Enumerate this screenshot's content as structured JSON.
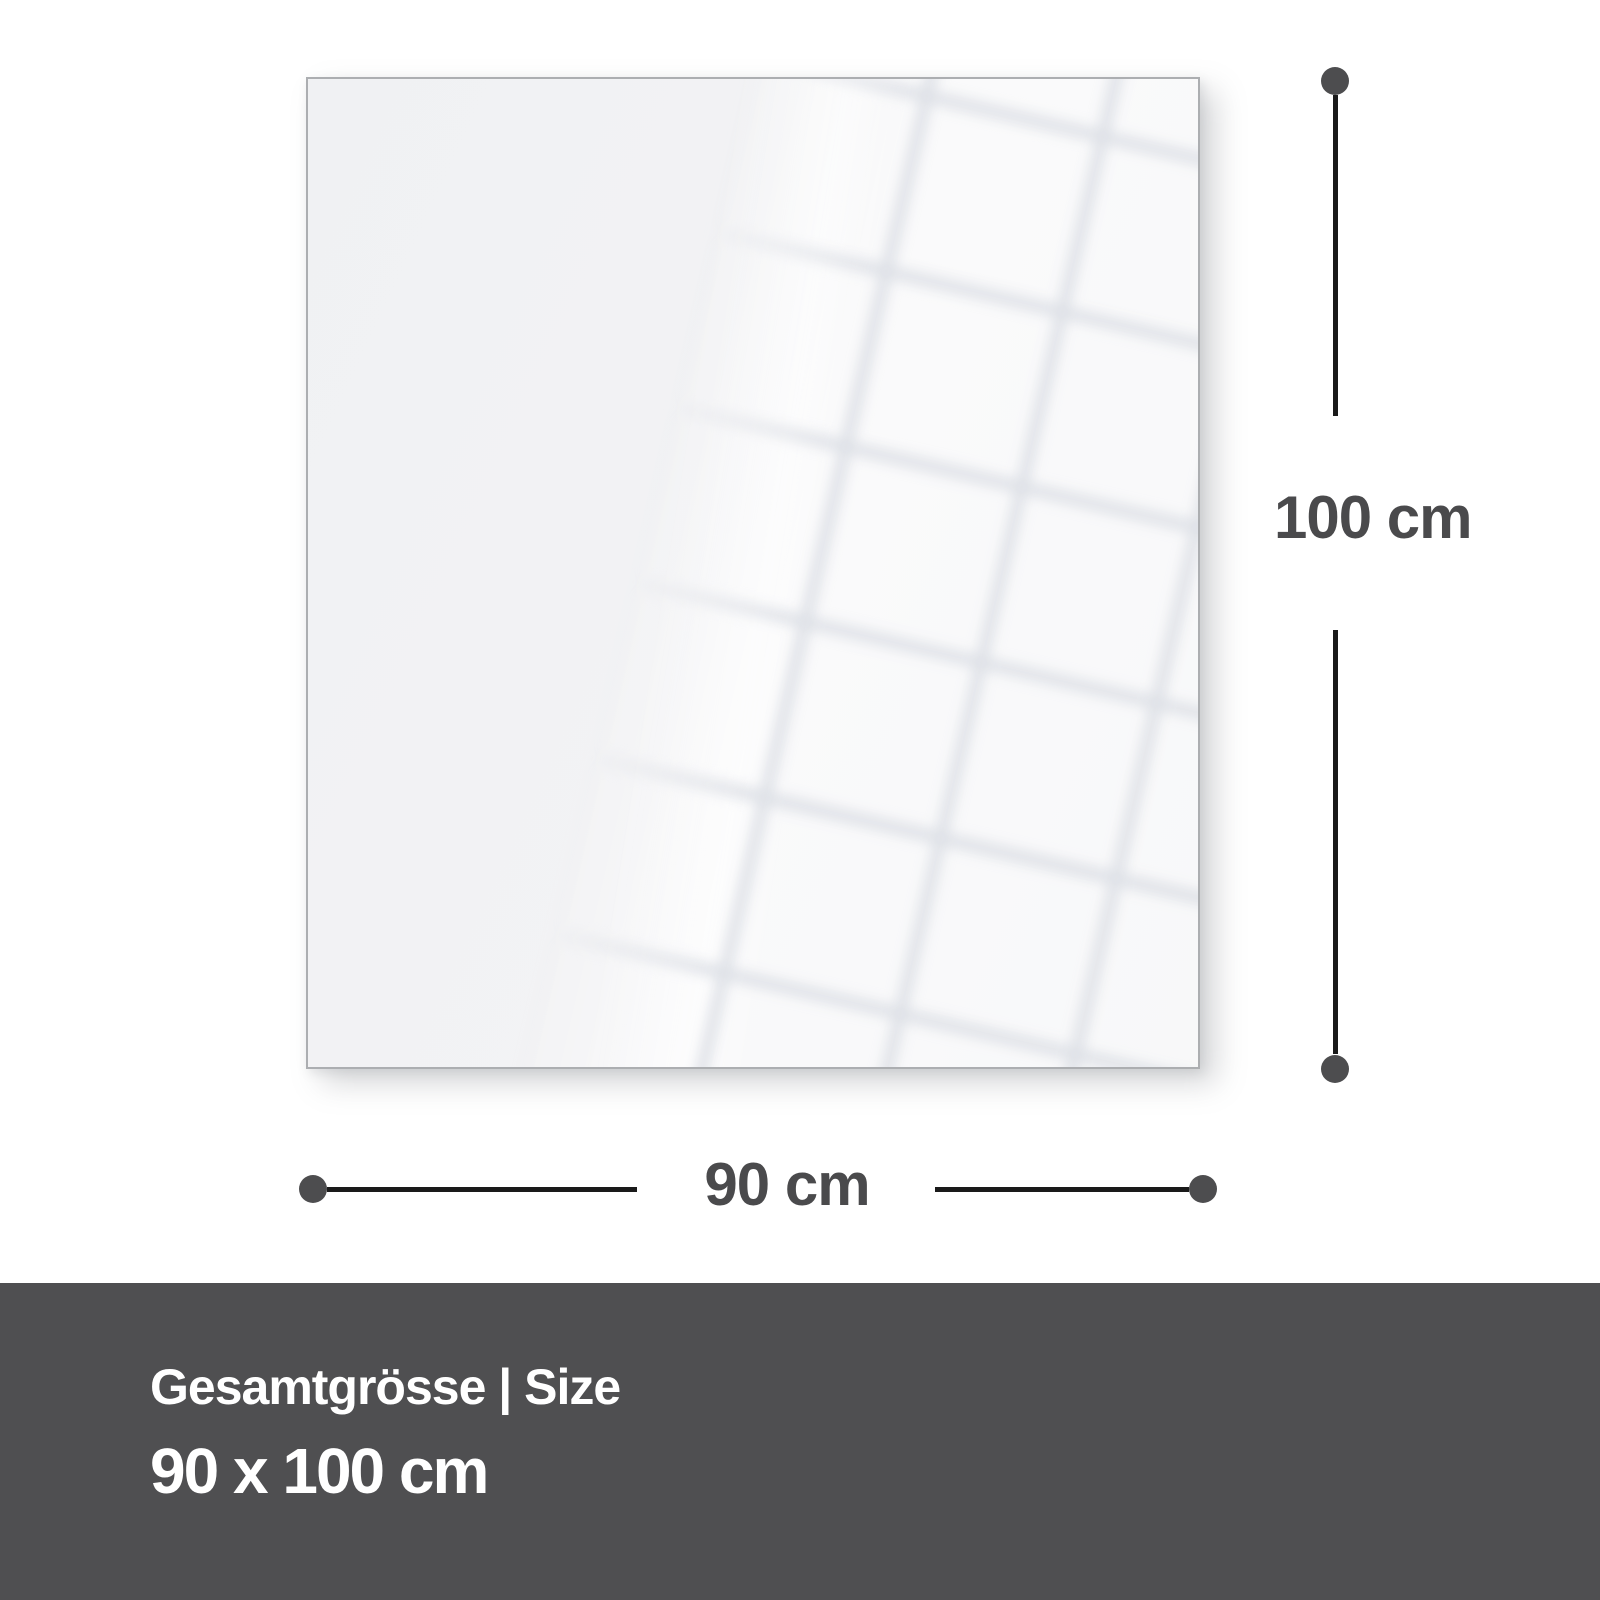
{
  "diagram": {
    "height_dimension": {
      "label": "100 cm"
    },
    "width_dimension": {
      "label": "90 cm"
    }
  },
  "footer": {
    "heading": "Gesamtgrösse | Size",
    "value": "90 x 100 cm"
  },
  "colors": {
    "background": "#ffffff",
    "panel_fill": "#f1f2f4",
    "panel_border": "#acaeb1",
    "dimension_line": "#1a1a1a",
    "dimension_dot": "#4d4d4f",
    "dimension_text": "#4a4a4c",
    "footer_background": "#4f4f51",
    "footer_text": "#ffffff"
  }
}
